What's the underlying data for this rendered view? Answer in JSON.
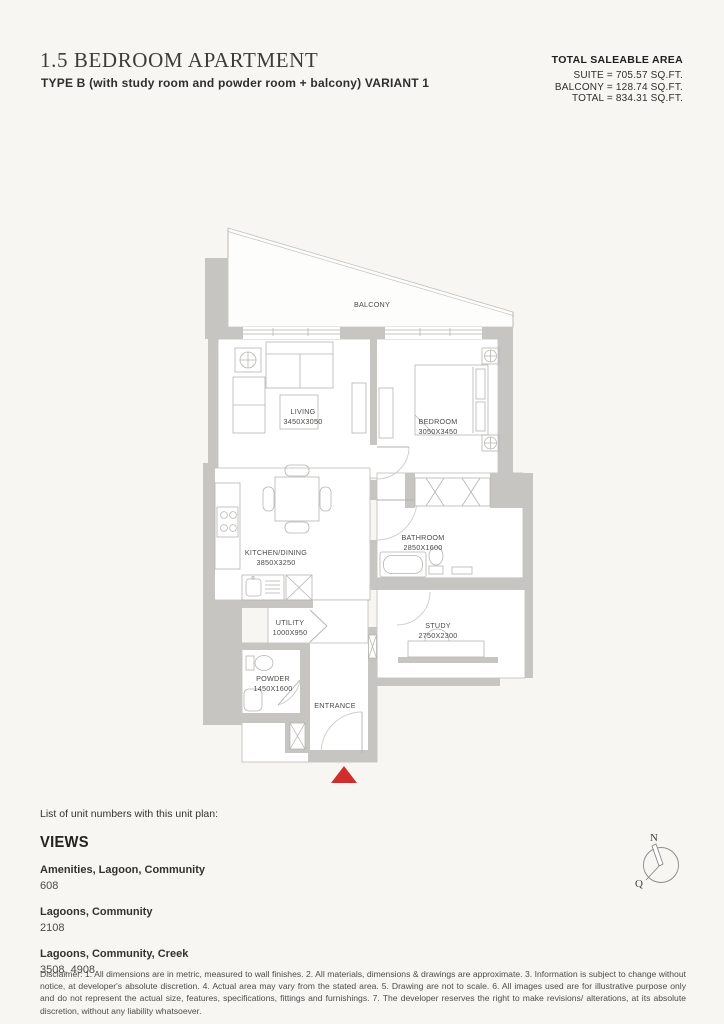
{
  "header": {
    "title": "1.5 BEDROOM APARTMENT",
    "subtitle": "TYPE B (with study room and powder room + balcony) VARIANT 1",
    "area_summary": {
      "heading": "TOTAL SALEABLE AREA",
      "lines": [
        "SUITE = 705.57 SQ.FT.",
        "BALCONY = 128.74 SQ.FT.",
        "TOTAL = 834.31 SQ.FT."
      ]
    }
  },
  "floor_plan": {
    "wall_color": "#c6c5c2",
    "entrance_marker_color": "#cf2e2c",
    "rooms": [
      {
        "name": "BALCONY",
        "dims": ""
      },
      {
        "name": "LIVING",
        "dims": "3450X3050"
      },
      {
        "name": "BEDROOM",
        "dims": "3050X3450"
      },
      {
        "name": "KITCHEN/DINING",
        "dims": "3850X3250"
      },
      {
        "name": "BATHROOM",
        "dims": "2850X1600"
      },
      {
        "name": "UTILITY",
        "dims": "1000X950"
      },
      {
        "name": "STUDY",
        "dims": "2750X2300"
      },
      {
        "name": "POWDER",
        "dims": "1450X1600"
      },
      {
        "name": "ENTRANCE",
        "dims": ""
      }
    ]
  },
  "unit_list": {
    "intro": "List of unit numbers with this unit plan:",
    "views_heading": "VIEWS",
    "groups": [
      {
        "view": "Amenities, Lagoon, Community",
        "units": "608"
      },
      {
        "view": "Lagoons, Community",
        "units": "2108"
      },
      {
        "view": "Lagoons, Community, Creek",
        "units": "3508, 4908"
      }
    ]
  },
  "compass": {
    "north_label": "N",
    "q_label": "Q"
  },
  "disclaimer": "Disclaimer: 1. All dimensions are in metric, measured to wall finishes. 2. All materials, dimensions & drawings are approximate. 3. Information is subject to change without notice, at developer's absolute discretion. 4. Actual area may vary from the stated area. 5. Drawing are not to scale. 6. All images used are for illustrative purpose only and do not represent the actual size, features, specifications, fittings and furnishings. 7. The developer reserves the right to make revisions/ alterations, at its absolute discretion, without any liability whatsoever."
}
